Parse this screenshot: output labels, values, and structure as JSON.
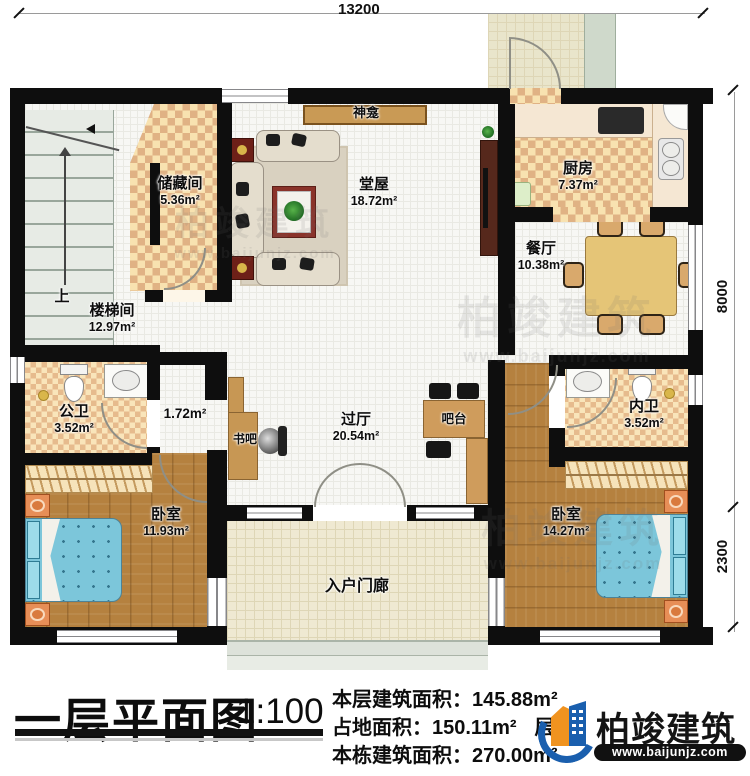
{
  "dimensions": {
    "top": "13200",
    "right_upper": "8000",
    "right_lower": "2300"
  },
  "rooms": {
    "stairwell": {
      "name": "楼梯间",
      "area": "12.97m²"
    },
    "stair_up": {
      "name": "上"
    },
    "storage": {
      "name": "储藏间",
      "area": "5.36m²"
    },
    "shrine": {
      "name": "神龛"
    },
    "hall": {
      "name": "堂屋",
      "area": "18.72m²"
    },
    "kitchen": {
      "name": "厨房",
      "area": "7.37m²"
    },
    "dining": {
      "name": "餐厅",
      "area": "10.38m²"
    },
    "public_bath": {
      "name": "公卫",
      "area": "3.52m²"
    },
    "closet": {
      "area": "1.72m²"
    },
    "book_bar": {
      "name": "书吧"
    },
    "hallway": {
      "name": "过厅",
      "area": "20.54m²"
    },
    "bar_counter": {
      "name": "吧台"
    },
    "ensuite_bath": {
      "name": "内卫",
      "area": "3.52m²"
    },
    "bedroom_left": {
      "name": "卧室",
      "area": "11.93m²"
    },
    "bedroom_right": {
      "name": "卧室",
      "area": "14.27m²"
    },
    "entry_porch": {
      "name": "入户门廊"
    }
  },
  "title_block": {
    "title": "一层平面图",
    "scale": "1:100",
    "stats": {
      "floor_area_label": "本层建筑面积：",
      "floor_area_value": "145.88m²",
      "footprint_label": "占地面积：",
      "footprint_value": "150.11m²",
      "height_label": "层高：",
      "total_area_label": "本栋建筑面积：",
      "total_area_value": "270.00m²"
    }
  },
  "brand": {
    "name": "柏竣建筑",
    "website": "www.baijunjz.com"
  },
  "watermark": {
    "name": "柏竣建筑",
    "website": "www.baijunjz.com"
  }
}
